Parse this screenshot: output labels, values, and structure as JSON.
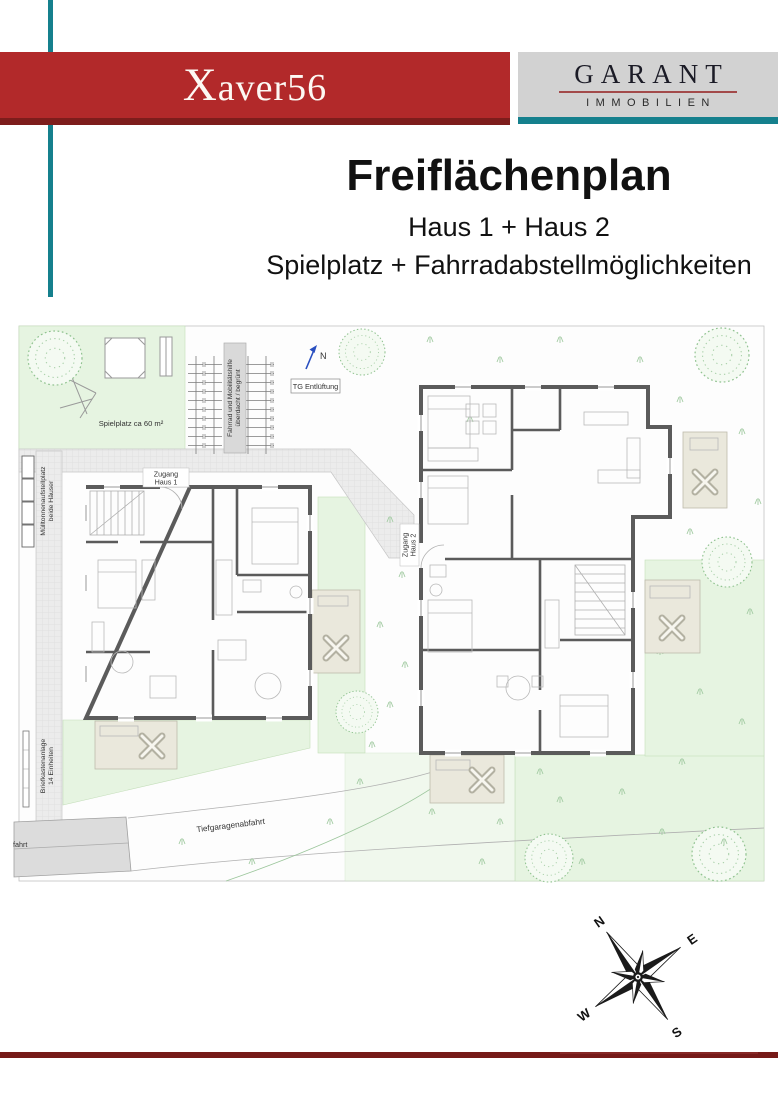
{
  "header": {
    "project_title": "Xaver56",
    "logo": {
      "brand": "GARANT",
      "subtitle": "IMMOBILIEN"
    }
  },
  "title_block": {
    "title": "Freiflächenplan",
    "subtitle1": "Haus 1 + Haus 2",
    "subtitle2": "Spielplatz + Fahrradabstellmöglichkeiten"
  },
  "plan": {
    "labels": {
      "spielplatz": "Spielplatz ca 60 m²",
      "fahrrad_line1": "Fahrrad und Mobilitätshilfe",
      "fahrrad_line2": "überdacht / begrünt",
      "tg_entlueftung": "TG Entlüftung",
      "north_marker": "N",
      "zugang_haus1_line1": "Zugang",
      "zugang_haus1_line2": "Haus 1",
      "zugang_haus2_line1": "Zugang",
      "zugang_haus2_line2": "Haus 2",
      "muelltonnen_line1": "Mülltonnenaufstellplatz",
      "muelltonnen_line2": "beide Häuser",
      "briefkasten_line1": "Briefkastenanlage",
      "briefkasten_line2": "14 Einheiten",
      "tiefgarage": "Tiefgaragenabfahrt",
      "zufahrt_partial": "fahrt"
    }
  },
  "compass": {
    "n": "N",
    "e": "E",
    "s": "S",
    "w": "W"
  },
  "colors": {
    "banner_red": "#b2292a",
    "banner_red_dark": "#7d1d1c",
    "teal": "#15808d",
    "logo_bg": "#d2d2d2",
    "logo_text": "#1b1b26",
    "logo_underline": "#a34a4a",
    "bottom_line": "#761a18",
    "wall_gray": "#5b5b5b",
    "plan_green": "#e6f4e1",
    "terrace_beige": "#eae8dc",
    "north_blue": "#2a4fc0"
  }
}
